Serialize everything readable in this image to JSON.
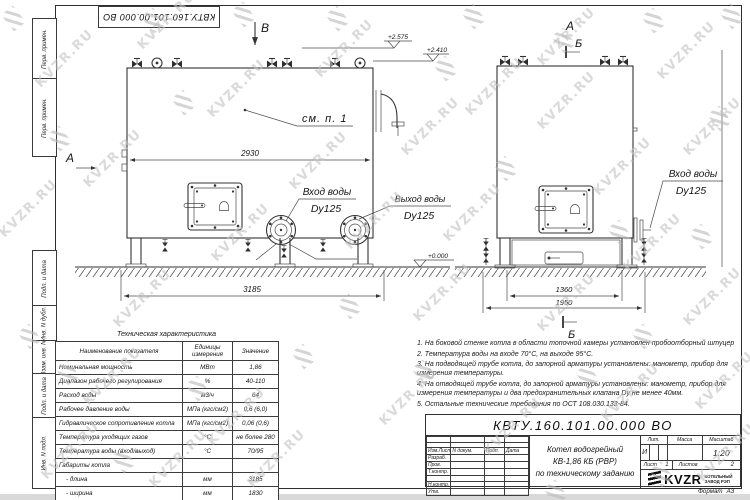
{
  "watermark": {
    "text": "KVZR.RU"
  },
  "sheet": {
    "top_designation": "КВТУ.160.101.00.000 ВО",
    "margin_labels": [
      "Перв. примен.",
      "Перв. примен.",
      "Подп. и дата",
      "Инв. N дубл.",
      "Взам. инв. N",
      "Подп. и дата",
      "Инв. N подл."
    ]
  },
  "front_view": {
    "view_label_top": "В",
    "view_label_left": "А",
    "see_note": "см. п. 1",
    "dim_top": "2930",
    "dim_bottom": "3185",
    "elev_high": "+2.575",
    "elev_mid": "+2.410",
    "elev_zero": "+0.000",
    "inlet_label": "Вход воды",
    "inlet_dn": "Dy125",
    "outlet_label": "Выход воды",
    "outlet_dn": "Dy125"
  },
  "side_view": {
    "view_label": "А",
    "section_label_top": "Б",
    "section_label_bottom": "Б",
    "dim_inner": "1360",
    "dim_outer": "1950",
    "inlet_label": "Вход воды",
    "inlet_dn": "Dy125"
  },
  "tech_table": {
    "title": "Техническая характеристика",
    "headers": [
      "Наименование показателя",
      "Единицы измерения",
      "Значение"
    ],
    "rows": [
      [
        "Номинальная мощность",
        "МВт",
        "1,86"
      ],
      [
        "Диапазон рабочего регулирования",
        "%",
        "40-110"
      ],
      [
        "Расход воды",
        "м3/ч",
        "64"
      ],
      [
        "Рабочее давление воды",
        "МПа (кгс/см2)",
        "0,6 (6,0)"
      ],
      [
        "Гидравлическое сопротивление котла",
        "МПа (кгс/см2)",
        "0,06 (0,6)"
      ],
      [
        "Температура уходящих газов",
        "°С",
        "не более 280"
      ],
      [
        "Температура воды (вход/выход)",
        "°С",
        "70/95"
      ],
      [
        "Габариты котла",
        "",
        ""
      ],
      [
        "    - длина",
        "мм",
        "3185"
      ],
      [
        "    - ширина",
        "мм",
        "1830"
      ],
      [
        "    - высота",
        "мм",
        "2460"
      ]
    ]
  },
  "notes": [
    "1.  На боковой стенке котла в области топочной камеры установлен пробоотборный штуцер",
    "2.  Температура воды на входе 70°С, на выходе 95°С.",
    "3.  На подводящей трубе котла, до запорной арматуры установлены: манометр, прибор для измерения температуры.",
    "4.  На отводящей трубе котла, до запорной арматуры установлены: манометр, прибор для измерения температуры и два предохранительных клапана Dу не менее 40мм.",
    "5.  Остальные технические требования по ОСТ 108.030.133-84."
  ],
  "title_block": {
    "designation": "КВТУ.160.101.00.000  ВО",
    "title_lines": [
      "Котел водогрейный",
      "КВ-1,86 КБ (РВР)",
      "по техническому заданию"
    ],
    "rev_headers": [
      "Изм.Лист",
      "N докум.",
      "Подп.",
      "Дата"
    ],
    "role_rows": [
      "Разраб.",
      "Пров.",
      "Т.контр.",
      "Н.контр.",
      "Утв."
    ],
    "lit_label": "Лит.",
    "lit_value": "И",
    "mass_label": "Масса",
    "scale_label": "Масштаб",
    "scale_value": "1:20",
    "sheet_label": "Лист",
    "sheet_value": "1",
    "sheets_label": "Листов",
    "sheets_value": "2",
    "logo_text": "KVZR",
    "logo_sub1": "КОТЕЛЬНЫЙ",
    "logo_sub2": "ЗАВОД РЭП",
    "format_label": "Формат",
    "format_value": "А3"
  }
}
